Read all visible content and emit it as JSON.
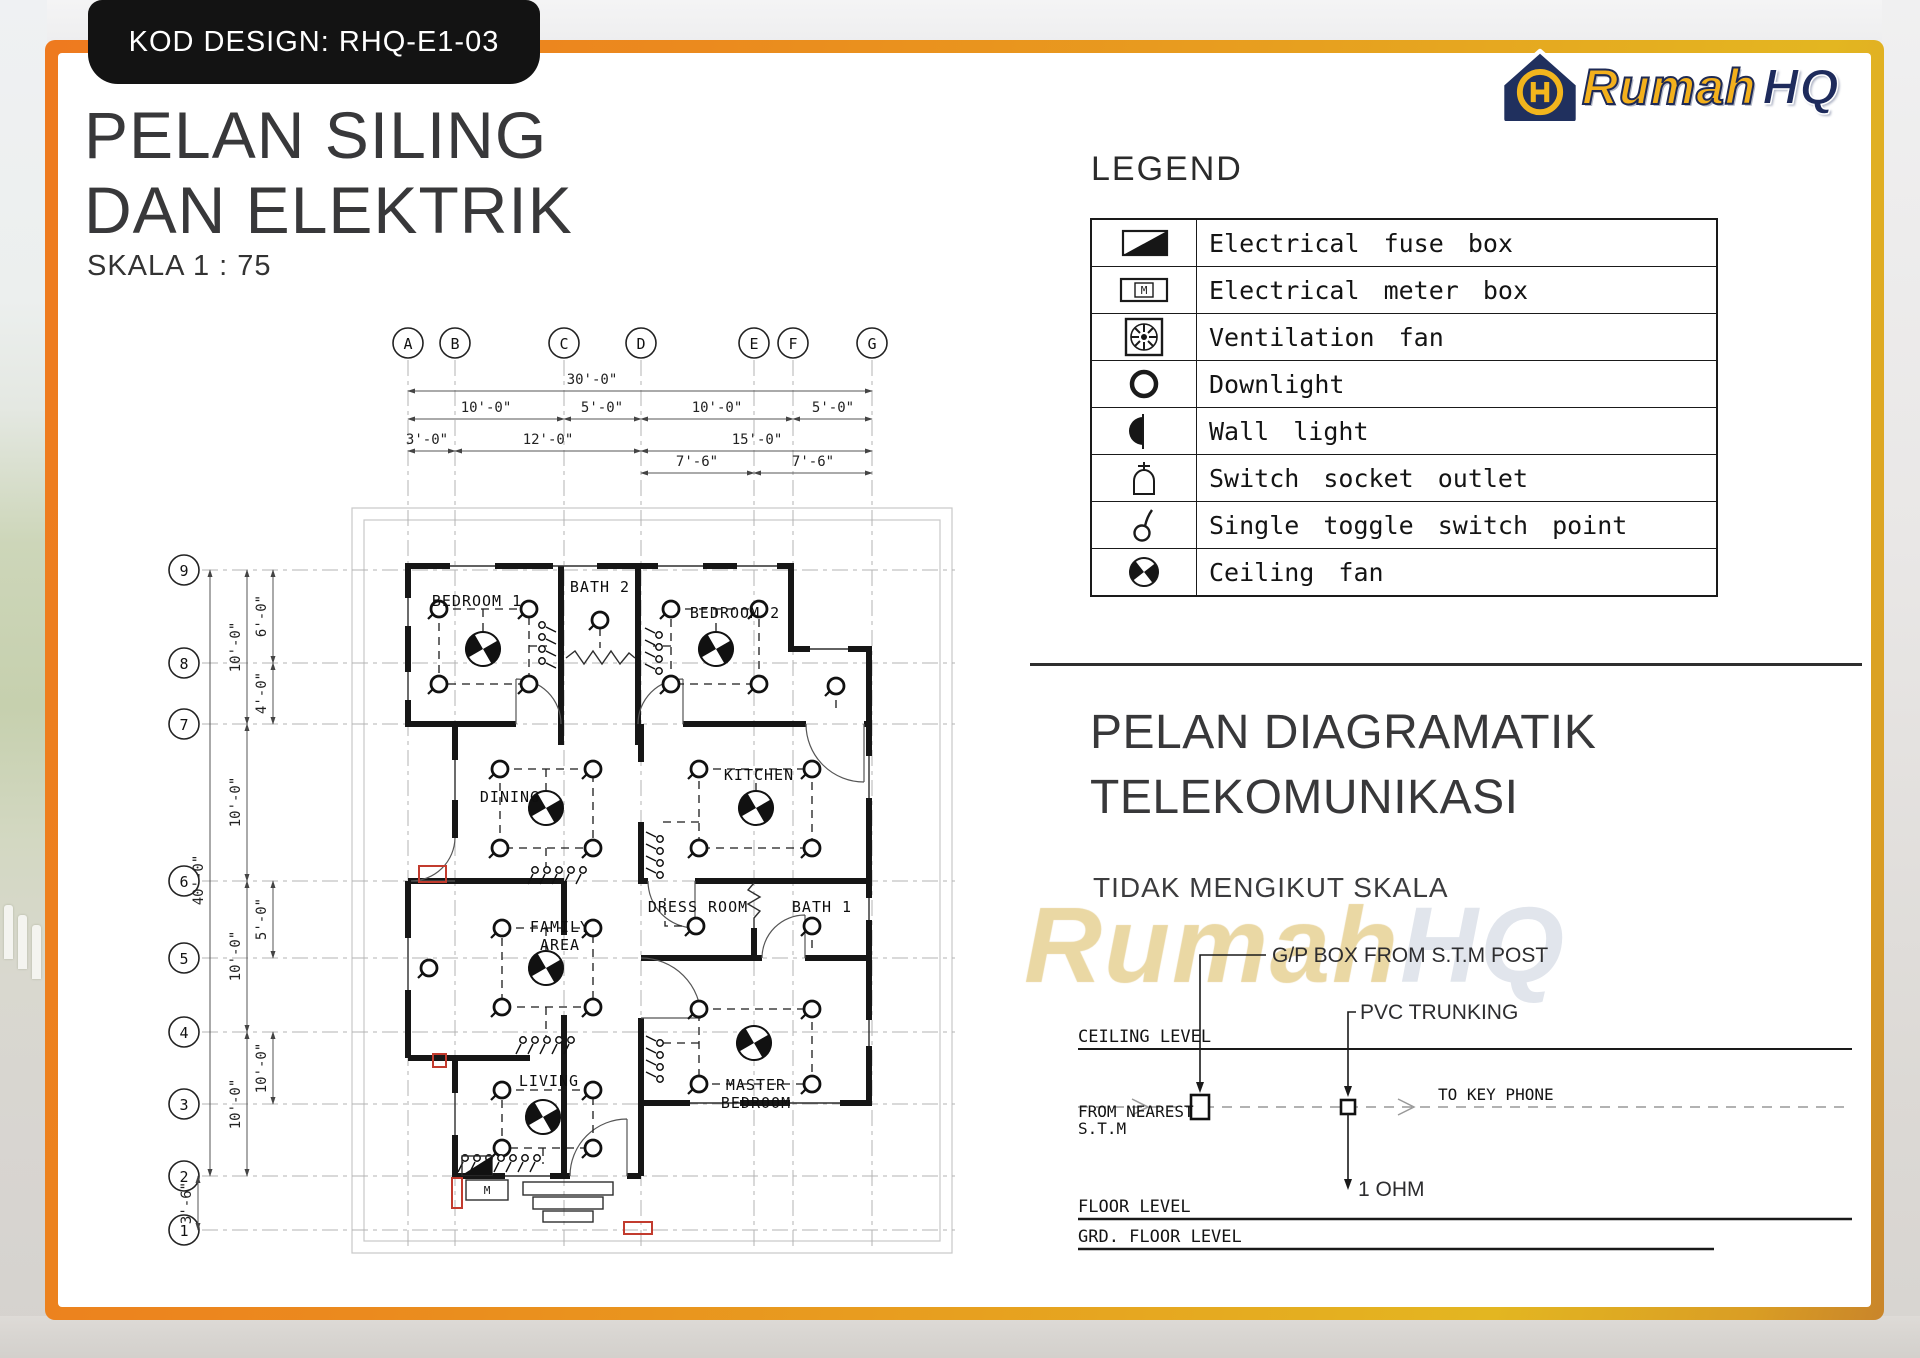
{
  "badge": {
    "label": "KOD DESIGN: RHQ-E1-03"
  },
  "titles": {
    "main_line1": "PELAN SILING",
    "main_line2": "DAN ELEKTRIK",
    "scale": "SKALA 1 : 75"
  },
  "logo": {
    "brand_rumah": "Rumah",
    "brand_hq": "HQ"
  },
  "watermark": {
    "rumah": "Rumah",
    "hq": "HQ"
  },
  "legend": {
    "title": "LEGEND",
    "items": [
      {
        "symbol": "electrical-fuse-box-icon",
        "label": "Electrical fuse box"
      },
      {
        "symbol": "electrical-meter-box-icon",
        "label": "Electrical meter box"
      },
      {
        "symbol": "ventilation-fan-icon",
        "label": "Ventilation fan"
      },
      {
        "symbol": "downlight-icon",
        "label": "Downlight"
      },
      {
        "symbol": "wall-light-icon",
        "label": "Wall light"
      },
      {
        "symbol": "switch-socket-outlet-icon",
        "label": "Switch socket outlet"
      },
      {
        "symbol": "single-toggle-switch-icon",
        "label": "Single toggle switch point"
      },
      {
        "symbol": "ceiling-fan-icon",
        "label": "Ceiling fan"
      }
    ]
  },
  "telecom": {
    "title_line1": "PELAN DIAGRAMATIK",
    "title_line2": "TELEKOMUNIKASI",
    "subtitle": "TIDAK MENGIKUT SKALA",
    "labels": {
      "gp_box": "G/P BOX FROM  S.T.M  POST",
      "pvc": "PVC TRUNKING",
      "ceiling": "CEILING  LEVEL",
      "from_1": "FROM  NEAREST",
      "from_2": "S.T.M",
      "to": "TO  KEY  PHONE",
      "ohm": "1 OHM",
      "floor": "FLOOR  LEVEL",
      "grd": "GRD.  FLOOR  LEVEL"
    }
  },
  "symbols": {
    "meter_m": "M"
  },
  "plan": {
    "scale_note": "1 : 75",
    "grid_cols": [
      "A",
      "B",
      "C",
      "D",
      "E",
      "F",
      "G"
    ],
    "grid_rows": [
      "9",
      "8",
      "7",
      "6",
      "5",
      "4",
      "3",
      "2",
      "1"
    ],
    "rooms": {
      "bedroom1": "BEDROOM 1",
      "bath2": "BATH 2",
      "bedroom2": "BEDROOM 2",
      "dining": "DINING",
      "kitchen": "KITCHEN",
      "dress": "DRESS ROOM",
      "bath1": "BATH 1",
      "family1": "FAMILY",
      "family2": "AREA",
      "living": "LIVING",
      "master1": "MASTER",
      "master2": "BEDROOM"
    },
    "dims_top": {
      "overall": "30'-0\"",
      "r2": [
        "10'-0\"",
        "5'-0\"",
        "10'-0\"",
        "5'-0\""
      ],
      "r3": [
        "3'-0\"",
        "12'-0\"",
        "15'-0\""
      ],
      "r4": [
        "7'-6\"",
        "7'-6\""
      ]
    },
    "dims_left": {
      "overall": "40'-0\"",
      "c1": [
        "10'-0\"",
        "10'-0\"",
        "10'-0\"",
        "10'-0\""
      ],
      "c2": [
        "6'-0\"",
        "4'-0\"",
        "5'-0\"",
        "10'-0\""
      ],
      "porch": "3'-6\""
    }
  }
}
